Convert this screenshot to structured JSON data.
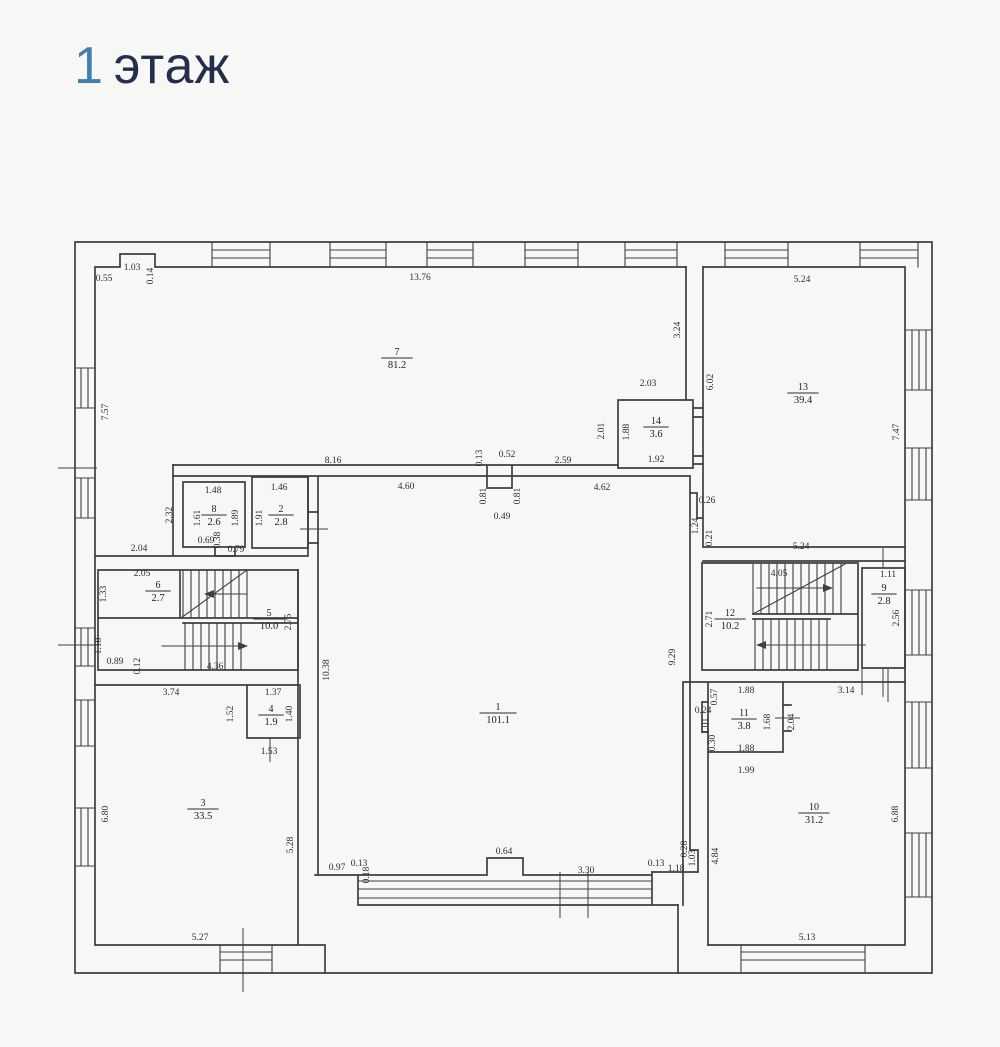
{
  "title": {
    "number": "1",
    "word": "этаж"
  },
  "colors": {
    "background": "#f7f7f5",
    "title_number": "#3f7fb0",
    "title_word": "#262e4e",
    "line": "#3f3f42"
  },
  "plan": {
    "rooms": [
      {
        "number": "7",
        "area": "81.2",
        "x": 397,
        "y": 357
      },
      {
        "number": "14",
        "area": "3.6",
        "x": 656,
        "y": 426
      },
      {
        "number": "13",
        "area": "39.4",
        "x": 803,
        "y": 392
      },
      {
        "number": "8",
        "area": "2.6",
        "x": 214,
        "y": 514
      },
      {
        "number": "2",
        "area": "2.8",
        "x": 281,
        "y": 514
      },
      {
        "number": "1",
        "area": "101.1",
        "x": 498,
        "y": 712
      },
      {
        "number": "6",
        "area": "2.7",
        "x": 158,
        "y": 590
      },
      {
        "number": "5",
        "area": "10.0",
        "x": 269,
        "y": 618
      },
      {
        "number": "12",
        "area": "10.2",
        "x": 730,
        "y": 618
      },
      {
        "number": "9",
        "area": "2.8",
        "x": 884,
        "y": 593
      },
      {
        "number": "3",
        "area": "33.5",
        "x": 203,
        "y": 808
      },
      {
        "number": "4",
        "area": "1.9",
        "x": 271,
        "y": 714
      },
      {
        "number": "11",
        "area": "3.8",
        "x": 744,
        "y": 718
      },
      {
        "number": "10",
        "area": "31.2",
        "x": 814,
        "y": 812
      }
    ],
    "dimensions": [
      {
        "t": "0.55",
        "x": 104,
        "y": 281
      },
      {
        "t": "1.03",
        "x": 132,
        "y": 270
      },
      {
        "t": "0.14",
        "x": 153,
        "y": 276,
        "v": 1
      },
      {
        "t": "13.76",
        "x": 420,
        "y": 280
      },
      {
        "t": "5.24",
        "x": 802,
        "y": 282
      },
      {
        "t": "3.24",
        "x": 680,
        "y": 330,
        "v": 1
      },
      {
        "t": "6.02",
        "x": 713,
        "y": 382,
        "v": 1
      },
      {
        "t": "7.47",
        "x": 899,
        "y": 432,
        "v": 1
      },
      {
        "t": "7.57",
        "x": 108,
        "y": 412,
        "v": 1
      },
      {
        "t": "2.03",
        "x": 648,
        "y": 386
      },
      {
        "t": "2.01",
        "x": 604,
        "y": 431,
        "v": 1
      },
      {
        "t": "1.88",
        "x": 629,
        "y": 432,
        "v": 1
      },
      {
        "t": "1.92",
        "x": 656,
        "y": 462
      },
      {
        "t": "8.16",
        "x": 333,
        "y": 463
      },
      {
        "t": "0.13",
        "x": 482,
        "y": 458,
        "v": 1
      },
      {
        "t": "0.52",
        "x": 507,
        "y": 457
      },
      {
        "t": "2.59",
        "x": 563,
        "y": 463
      },
      {
        "t": "4.60",
        "x": 406,
        "y": 489
      },
      {
        "t": "0.81",
        "x": 486,
        "y": 496,
        "v": 1
      },
      {
        "t": "0.81",
        "x": 520,
        "y": 496,
        "v": 1
      },
      {
        "t": "0.49",
        "x": 502,
        "y": 519
      },
      {
        "t": "4.62",
        "x": 602,
        "y": 490
      },
      {
        "t": "0.26",
        "x": 707,
        "y": 503
      },
      {
        "t": "1.24",
        "x": 698,
        "y": 526,
        "v": 1
      },
      {
        "t": "0.21",
        "x": 712,
        "y": 538,
        "v": 1
      },
      {
        "t": "5.24",
        "x": 801,
        "y": 549
      },
      {
        "t": "2.32",
        "x": 172,
        "y": 515,
        "v": 1
      },
      {
        "t": "1.48",
        "x": 213,
        "y": 493
      },
      {
        "t": "1.61",
        "x": 200,
        "y": 518,
        "v": 1
      },
      {
        "t": "1.89",
        "x": 238,
        "y": 518,
        "v": 1
      },
      {
        "t": "0.69",
        "x": 206,
        "y": 543
      },
      {
        "t": "0.38",
        "x": 220,
        "y": 540,
        "v": 1
      },
      {
        "t": "0.79",
        "x": 236,
        "y": 552
      },
      {
        "t": "1.46",
        "x": 279,
        "y": 490
      },
      {
        "t": "1.91",
        "x": 262,
        "y": 518,
        "v": 1
      },
      {
        "t": "2.04",
        "x": 139,
        "y": 551
      },
      {
        "t": "2.05",
        "x": 142,
        "y": 576
      },
      {
        "t": "1.33",
        "x": 106,
        "y": 594,
        "v": 1
      },
      {
        "t": "4.05",
        "x": 779,
        "y": 576
      },
      {
        "t": "1.11",
        "x": 888,
        "y": 577
      },
      {
        "t": "2.71",
        "x": 712,
        "y": 619,
        "v": 1
      },
      {
        "t": "2.56",
        "x": 899,
        "y": 618,
        "v": 1
      },
      {
        "t": "2.75",
        "x": 291,
        "y": 622,
        "v": 1
      },
      {
        "t": "10.38",
        "x": 329,
        "y": 670,
        "v": 1
      },
      {
        "t": "9.29",
        "x": 675,
        "y": 657,
        "v": 1
      },
      {
        "t": "1.18",
        "x": 101,
        "y": 646,
        "v": 1
      },
      {
        "t": "0.89",
        "x": 115,
        "y": 664
      },
      {
        "t": "0.12",
        "x": 140,
        "y": 666,
        "v": 1
      },
      {
        "t": "4.36",
        "x": 215,
        "y": 669
      },
      {
        "t": "3.74",
        "x": 171,
        "y": 695
      },
      {
        "t": "1.37",
        "x": 273,
        "y": 695
      },
      {
        "t": "1.52",
        "x": 233,
        "y": 714,
        "v": 1
      },
      {
        "t": "1.40",
        "x": 292,
        "y": 714,
        "v": 1
      },
      {
        "t": "1.53",
        "x": 269,
        "y": 754
      },
      {
        "t": "1.88",
        "x": 746,
        "y": 693
      },
      {
        "t": "0.57",
        "x": 717,
        "y": 697,
        "v": 1
      },
      {
        "t": "3.14",
        "x": 846,
        "y": 693
      },
      {
        "t": "0.24",
        "x": 703,
        "y": 713
      },
      {
        "t": "1.01",
        "x": 708,
        "y": 726,
        "v": 1
      },
      {
        "t": "0.30",
        "x": 715,
        "y": 743,
        "v": 1
      },
      {
        "t": "1.88",
        "x": 746,
        "y": 751
      },
      {
        "t": "1.68",
        "x": 770,
        "y": 722,
        "v": 1
      },
      {
        "t": "2.04",
        "x": 794,
        "y": 722,
        "v": 1
      },
      {
        "t": "1.99",
        "x": 746,
        "y": 773
      },
      {
        "t": "6.80",
        "x": 108,
        "y": 814,
        "v": 1
      },
      {
        "t": "5.28",
        "x": 293,
        "y": 845,
        "v": 1
      },
      {
        "t": "0.97",
        "x": 337,
        "y": 870
      },
      {
        "t": "0.13",
        "x": 359,
        "y": 866
      },
      {
        "t": "0.18",
        "x": 369,
        "y": 875,
        "v": 1
      },
      {
        "t": "0.64",
        "x": 504,
        "y": 854
      },
      {
        "t": "3.30",
        "x": 586,
        "y": 873
      },
      {
        "t": "0.13",
        "x": 656,
        "y": 866
      },
      {
        "t": "1.18",
        "x": 676,
        "y": 871
      },
      {
        "t": "0.28",
        "x": 687,
        "y": 849,
        "v": 1
      },
      {
        "t": "1.03",
        "x": 695,
        "y": 858,
        "v": 1
      },
      {
        "t": "4.84",
        "x": 718,
        "y": 856,
        "v": 1
      },
      {
        "t": "6.88",
        "x": 898,
        "y": 814,
        "v": 1
      },
      {
        "t": "5.27",
        "x": 200,
        "y": 940
      },
      {
        "t": "5.13",
        "x": 807,
        "y": 940
      }
    ]
  }
}
